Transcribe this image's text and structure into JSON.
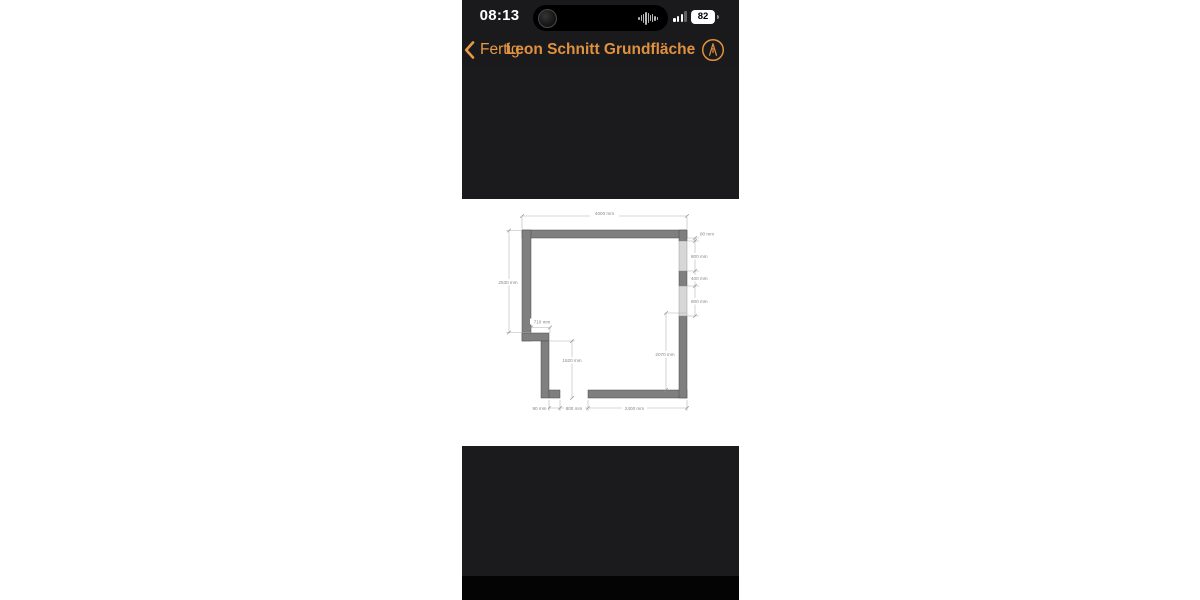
{
  "status_bar": {
    "time": "08:13",
    "battery_percent": "82",
    "signal_icon": "cellular-signal-bars",
    "dynamic_island": {
      "left_icon": "album-art-circle",
      "right_icon": "audio-waveform"
    }
  },
  "nav_bar": {
    "back_label": "Fertig",
    "title": "Leon Schnitt Grundfläche",
    "back_icon": "chevron-left",
    "markup_icon": "markup-pen-in-circle",
    "accent_color": "#e29140"
  },
  "document": {
    "type": "floor-plan",
    "unit": "mm",
    "dimensions": {
      "top_width": "4000 mm",
      "left_height": "2530 mm",
      "step_width": "710 mm",
      "step_height": "1620 mm",
      "right_inner_height": "2070 mm",
      "bottom_stub": "90 mm",
      "bottom_opening": "800 mm",
      "bottom_wall": "2400 mm",
      "right_top": "80 mm",
      "right_window_upper": "800 mm",
      "right_pier": "400 mm",
      "right_window_lower": "800 mm"
    },
    "colors": {
      "wall": "#7f7f7f",
      "window": "#d7d7d7",
      "dimension_line": "#b0b0b0",
      "dimension_text": "#868686"
    }
  }
}
